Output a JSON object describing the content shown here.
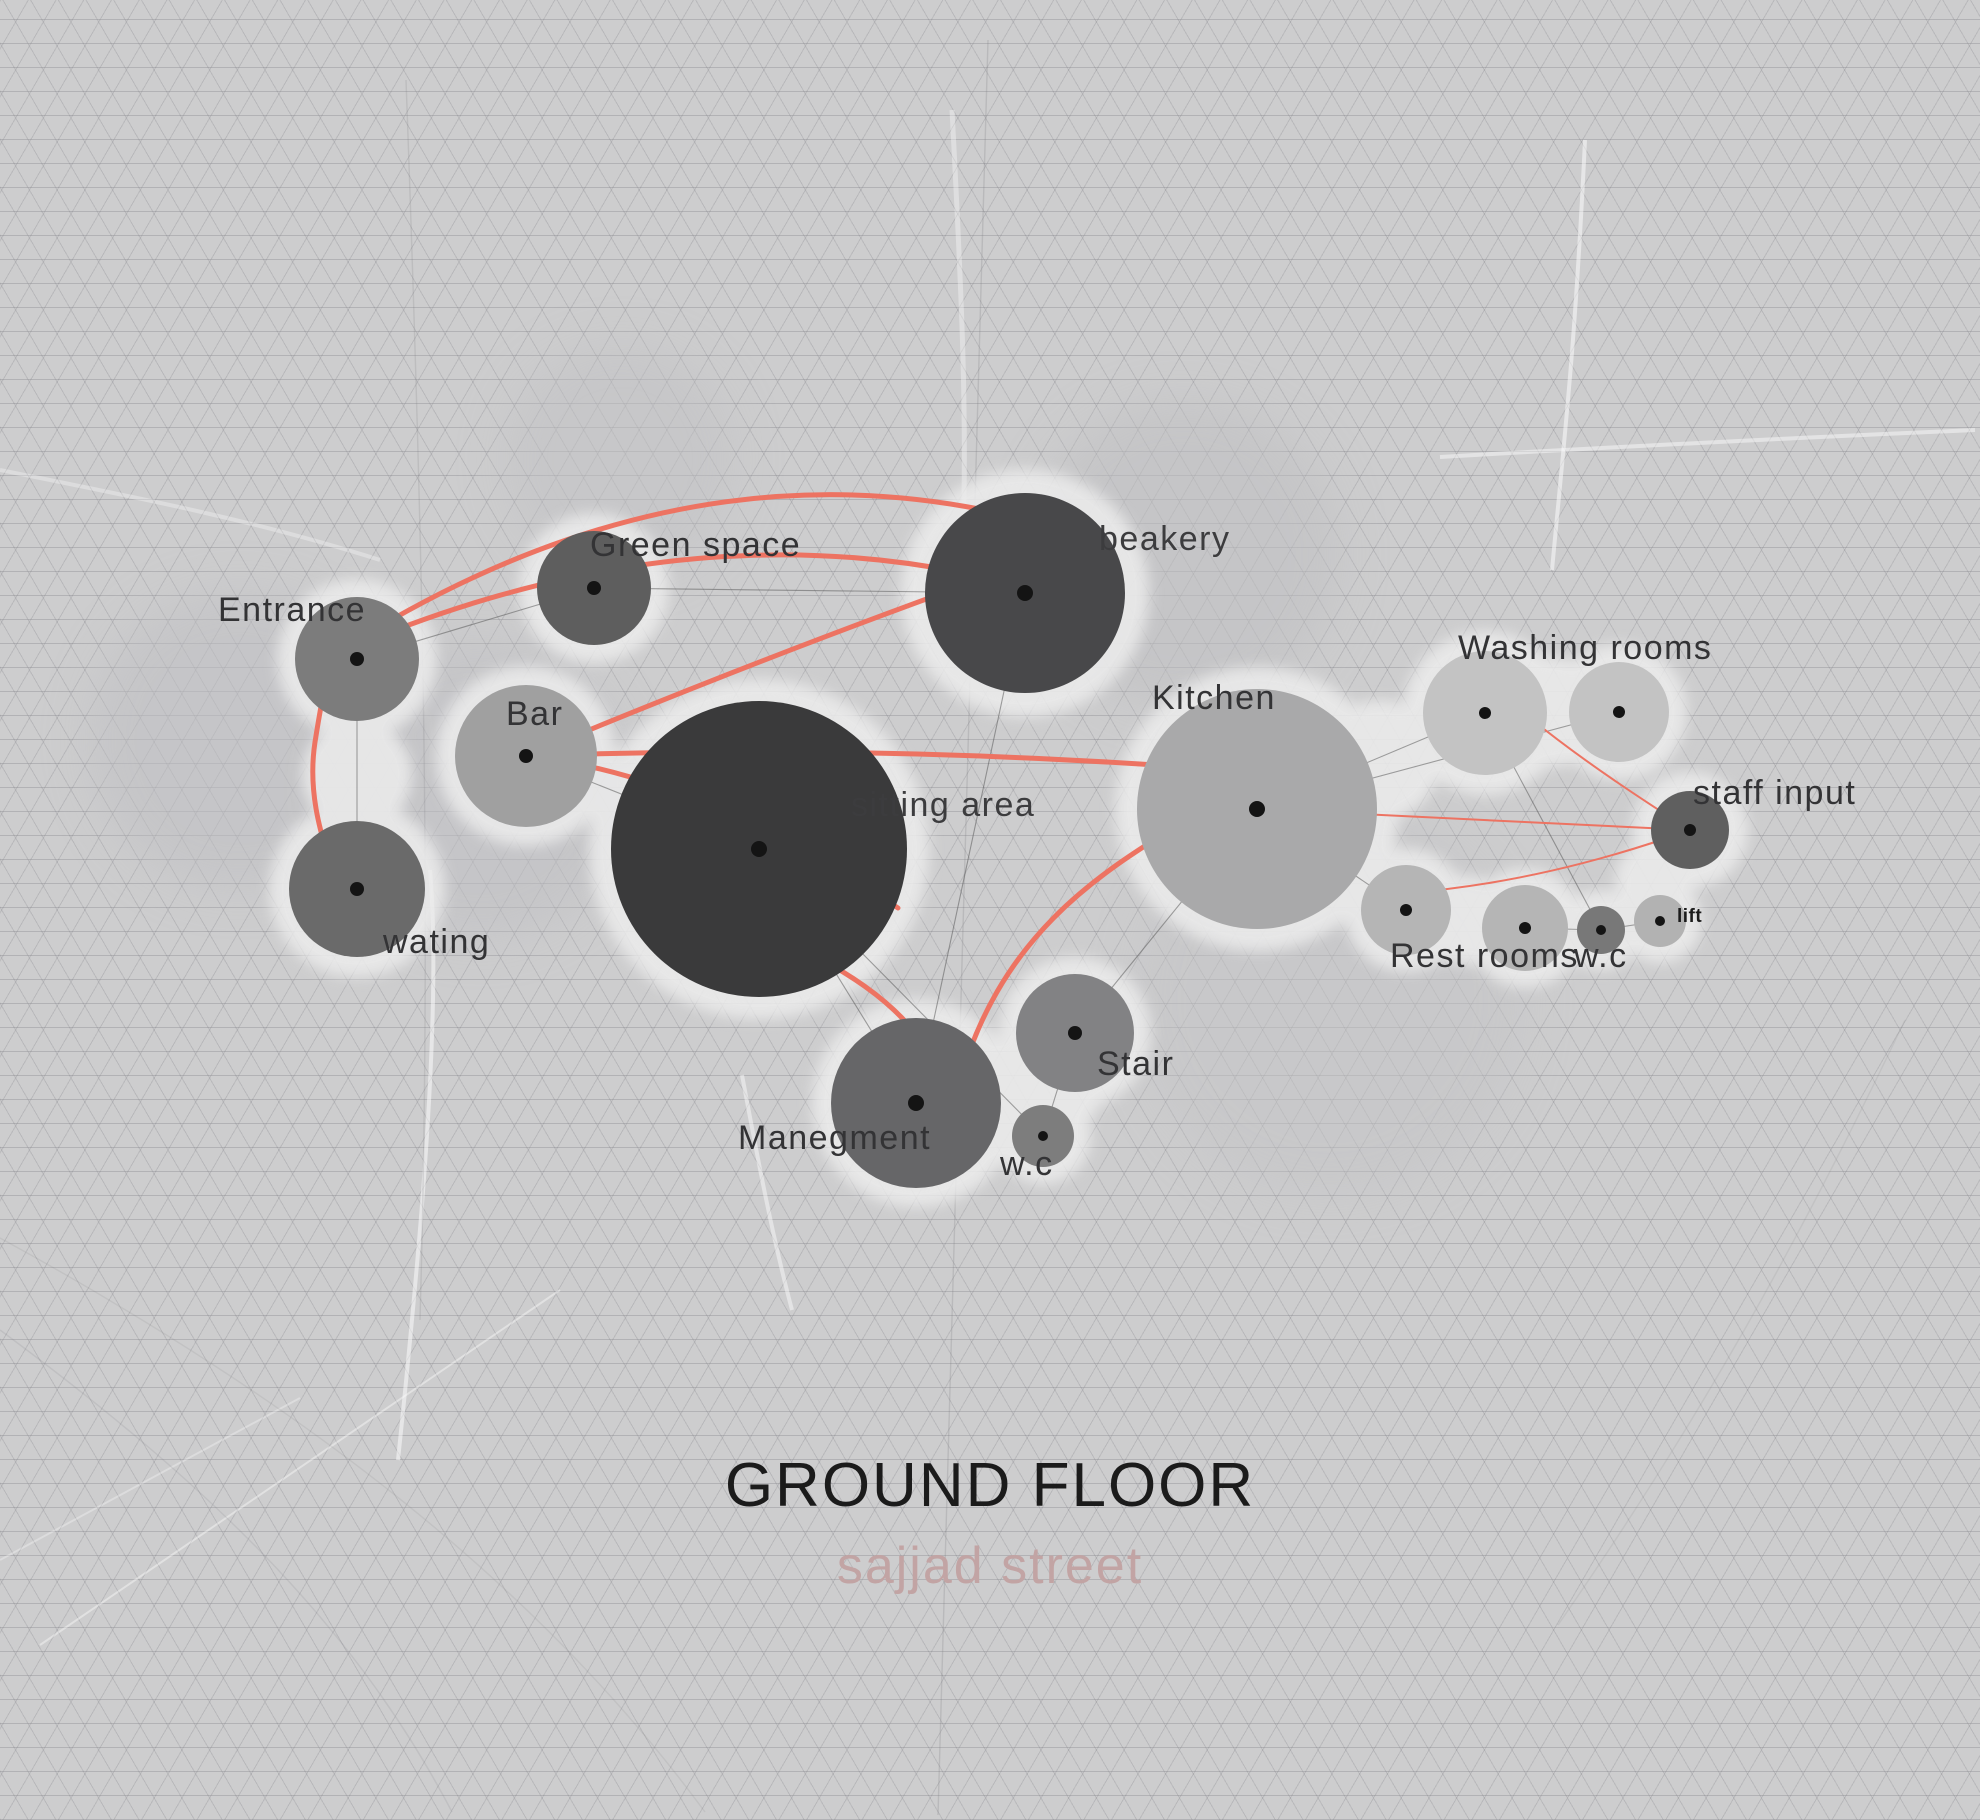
{
  "title": "GROUND FLOOR",
  "subtitle": "sajjad street",
  "palette": {
    "background": "#cdcdce",
    "halo": "#ebebeb",
    "accent_red": "#ed7362",
    "connection_gray": "#5c5c5c",
    "label_color": "#333335"
  },
  "nodes": {
    "entrance": {
      "label": "Entrance",
      "color": "#7c7c7c"
    },
    "wating": {
      "label": "wating",
      "color": "#6a6a6a"
    },
    "green_space": {
      "label": "Green space",
      "color": "#5e5e5e"
    },
    "bar": {
      "label": "Bar",
      "color": "#a0a0a0"
    },
    "sitting_area": {
      "label": "sitting area",
      "color": "#3a3a3b"
    },
    "beakery": {
      "label": "beakery",
      "color": "#48484a"
    },
    "kitchen": {
      "label": "Kitchen",
      "color": "#a9a9aa"
    },
    "washing_rooms": {
      "label": "Washing rooms",
      "color": "#c3c3c3"
    },
    "staff_input": {
      "label": "staff input",
      "color": "#5f5f5f"
    },
    "rest_rooms": {
      "label": "Rest rooms",
      "color": "#b5b5b5"
    },
    "wc_right": {
      "label": "w.c",
      "color": "#787878"
    },
    "lift": {
      "label": "lift",
      "color": "#b2b2b2"
    },
    "manegment": {
      "label": "Manegment",
      "color": "#666668"
    },
    "stair": {
      "label": "Stair",
      "color": "#828284"
    },
    "wc_center": {
      "label": "w.c",
      "color": "#7d7d7d"
    }
  },
  "connections": {
    "gray": [
      [
        "Entrance",
        "wating"
      ],
      [
        "Entrance",
        "Green space"
      ],
      [
        "Green space",
        "beakery"
      ],
      [
        "beakery",
        "Manegment"
      ],
      [
        "Bar",
        "sitting area"
      ],
      [
        "sitting area",
        "Manegment"
      ],
      [
        "sitting area",
        "w.c center"
      ],
      [
        "Kitchen",
        "Washing rooms left"
      ],
      [
        "Kitchen",
        "Washing rooms right"
      ],
      [
        "Kitchen",
        "Rest rooms"
      ],
      [
        "Kitchen",
        "Stair"
      ],
      [
        "Stair",
        "w.c center"
      ],
      [
        "Washing rooms left",
        "w.c small"
      ],
      [
        "Rest rooms",
        "w.c small"
      ],
      [
        "w.c small",
        "lift"
      ]
    ],
    "red": [
      [
        "wating",
        "Entrance"
      ],
      [
        "Entrance",
        "beakery"
      ],
      [
        "Bar",
        "beakery"
      ],
      [
        "Bar",
        "Kitchen"
      ],
      [
        "Bar",
        "sitting area"
      ],
      [
        "sitting area",
        "Manegment"
      ],
      [
        "Kitchen",
        "Manegment"
      ],
      [
        "Kitchen",
        "staff input"
      ],
      [
        "Washing rooms",
        "staff input"
      ],
      [
        "staff input",
        "Rest rooms"
      ]
    ]
  }
}
